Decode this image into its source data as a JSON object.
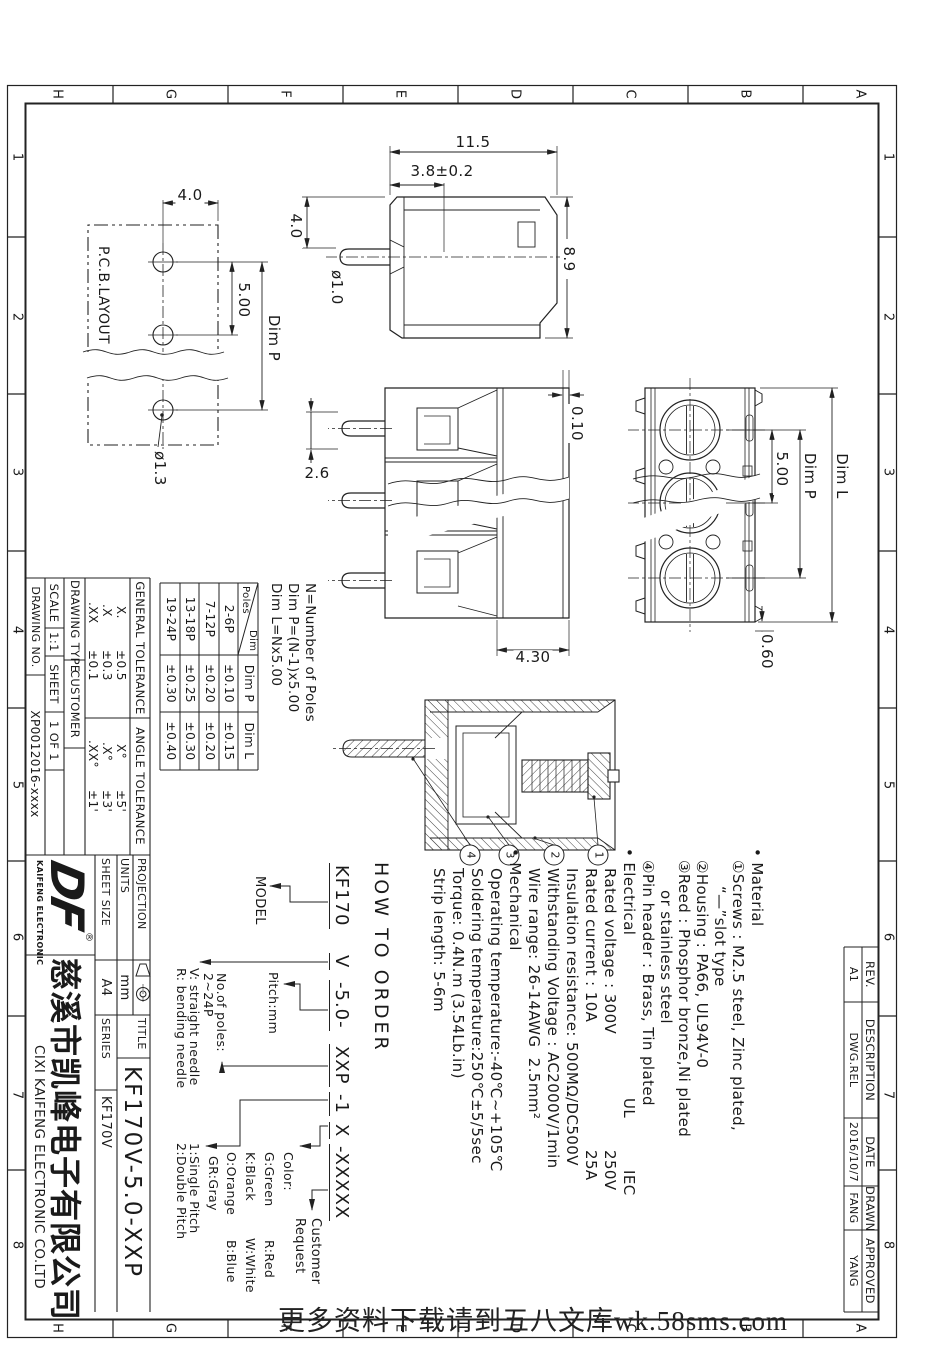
{
  "watermark": "更多资料下载请到五八文库wk.58sms.com",
  "frame": {
    "zone_letters": [
      "A",
      "B",
      "C",
      "D",
      "E",
      "F",
      "G",
      "H"
    ],
    "zone_numbers": [
      "1",
      "2",
      "3",
      "4",
      "5",
      "6",
      "7",
      "8"
    ]
  },
  "views": {
    "pcb": {
      "label": "P.C.B.LAYOUT",
      "dim_hole_edge": "4.0",
      "dim_pitch": "5.00",
      "dim_pitch_total": "Dim P",
      "dim_hole_dia": "ø1.3"
    },
    "side": {
      "dim_height": "11.5",
      "dim_pin_pos": "3.8±0.2",
      "dim_depth": "8.9",
      "dim_pin_offset": "4.0",
      "dim_pin_dia": "ø1.0"
    },
    "front": {
      "dim_step": "0.10",
      "dim_pin": "2.6",
      "dim_top": "4.30"
    },
    "top": {
      "dim_pitch": "5.00",
      "dim_p": "Dim P",
      "dim_l": "Dim L",
      "dim_tab": "0.60"
    },
    "section": {
      "balloons": [
        "1",
        "2",
        "3",
        "4"
      ]
    }
  },
  "pole_note": {
    "l1": "N=Number of Poles",
    "l2": "Dim P=(N-1)x5.00",
    "l3": "Dim L=Nx5.00"
  },
  "poles_table": {
    "diag_top": "Dim",
    "diag_bottom": "Poles",
    "col1": "Dim P",
    "col2": "Dim L",
    "rows": [
      {
        "poles": "2-6P",
        "p": "±0.10",
        "l": "±0.15"
      },
      {
        "poles": "7-12P",
        "p": "±0.20",
        "l": "±0.20"
      },
      {
        "poles": "13-18P",
        "p": "±0.25",
        "l": "±0.30"
      },
      {
        "poles": "19-24P",
        "p": "±0.30",
        "l": "±0.40"
      }
    ]
  },
  "tolerance": {
    "general_title": "GENERAL TOLERANCE",
    "angle_title": "ANGLE TOLERANCE",
    "general": [
      {
        "k": "X.",
        "v": "±0.5"
      },
      {
        "k": ".X",
        "v": "±0.3"
      },
      {
        "k": ".XX",
        "v": "±0.1"
      }
    ],
    "angle": [
      {
        "k": "X°",
        "v": "±5'"
      },
      {
        "k": ".X°",
        "v": "±3'"
      },
      {
        "k": ".XX°",
        "v": "±1'"
      }
    ]
  },
  "info": {
    "drawing_type_label": "DRAWING TYPE",
    "drawing_type": "CUSTOMER",
    "scale_label": "SCALE",
    "scale": "1:1",
    "sheet_label": "SHEET",
    "sheet": "1 OF 1",
    "drawing_no_label": "DRAWING NO.",
    "drawing_no": "XP0012016-xxxx"
  },
  "title_block": {
    "projection_label": "PROJECTION",
    "units_label": "UNITS",
    "units": "mm",
    "sheet_size_label": "SHEET SIZE",
    "sheet_size": "A4",
    "series_label": "SERIES",
    "series": "KF170V",
    "title_label": "TITLE",
    "title": "KF170V-5.0-XXP",
    "logo": "DF",
    "logo_reg": "®",
    "logo_sub": "KAIFENG ELECTRONIC",
    "company_cn": "慈溪市凯峰电子有限公司",
    "company_en": "CIXI KAIFENG ELECTRONIC CO.LTD"
  },
  "revision": {
    "h_rev": "REV.",
    "h_desc": "DESCRIPTION",
    "h_date": "DATE",
    "h_drawn": "DRAWN",
    "h_appr": "APPROVED",
    "rev": "A1",
    "desc": "DWG.REL",
    "date": "2016/10/7",
    "drawn": "FANG",
    "appr": "YANG"
  },
  "notes": {
    "material": {
      "title": "• Material",
      "l1": "①Screws : M2.5 steel, Zinc plated,",
      "l2": "“—”slot type",
      "l3": "②Housing : PA66, UL94V-0",
      "l4": "③Reed : Phosphor bronze,Ni plated",
      "l5": "or stainless steel",
      "l6": "④Pin header : Brass, Tin plated"
    },
    "electrical": {
      "title": "• Electrical",
      "std1": "UL",
      "std2": "IEC",
      "r1": "Rated voltage : 300V",
      "r1b": "250V",
      "r2": "Rated current : 10A",
      "r2b": "25A",
      "l3": "Insulation resistance: 500MΩ/DC500V",
      "l4": "Withstanding Voltage : AC2000V/1min",
      "l5": "Wire range: 26-14AWG  2.5mm²"
    },
    "mechanical": {
      "title": "• Mechanical",
      "l1": "Operating temperature:-40℃~+105℃",
      "l2": "Soldering temperature:250℃±5/5sec",
      "l3": "Torque: 0.4N.m (3.54Lb.in)",
      "l4": "Strip length: 5-6m"
    }
  },
  "order": {
    "title": "HOW TO ORDER",
    "g1": "KF170",
    "g2": "V",
    "g3": "-5.0-",
    "g4": "XXP",
    "g5": "-1",
    "g6": "X",
    "g7": "-XXXXX",
    "model": "MODEL",
    "pitch": "Pitch:mm",
    "poles1": "No.of poles:",
    "poles2": "2~24P",
    "needle1": "V: straight needle",
    "needle2": "R: bending needle",
    "pitch_type1": "1:Single Pitch",
    "pitch_type2": "2:Double Pitch",
    "color_title": "Color:",
    "c1a": "G:Green",
    "c1b": "R:Red",
    "c2a": "K:Black",
    "c2b": "W:White",
    "c3a": "O:Orange",
    "c3b": "B:Blue",
    "c4": "GR:Gray",
    "customer1": "Customer",
    "customer2": "Request"
  }
}
